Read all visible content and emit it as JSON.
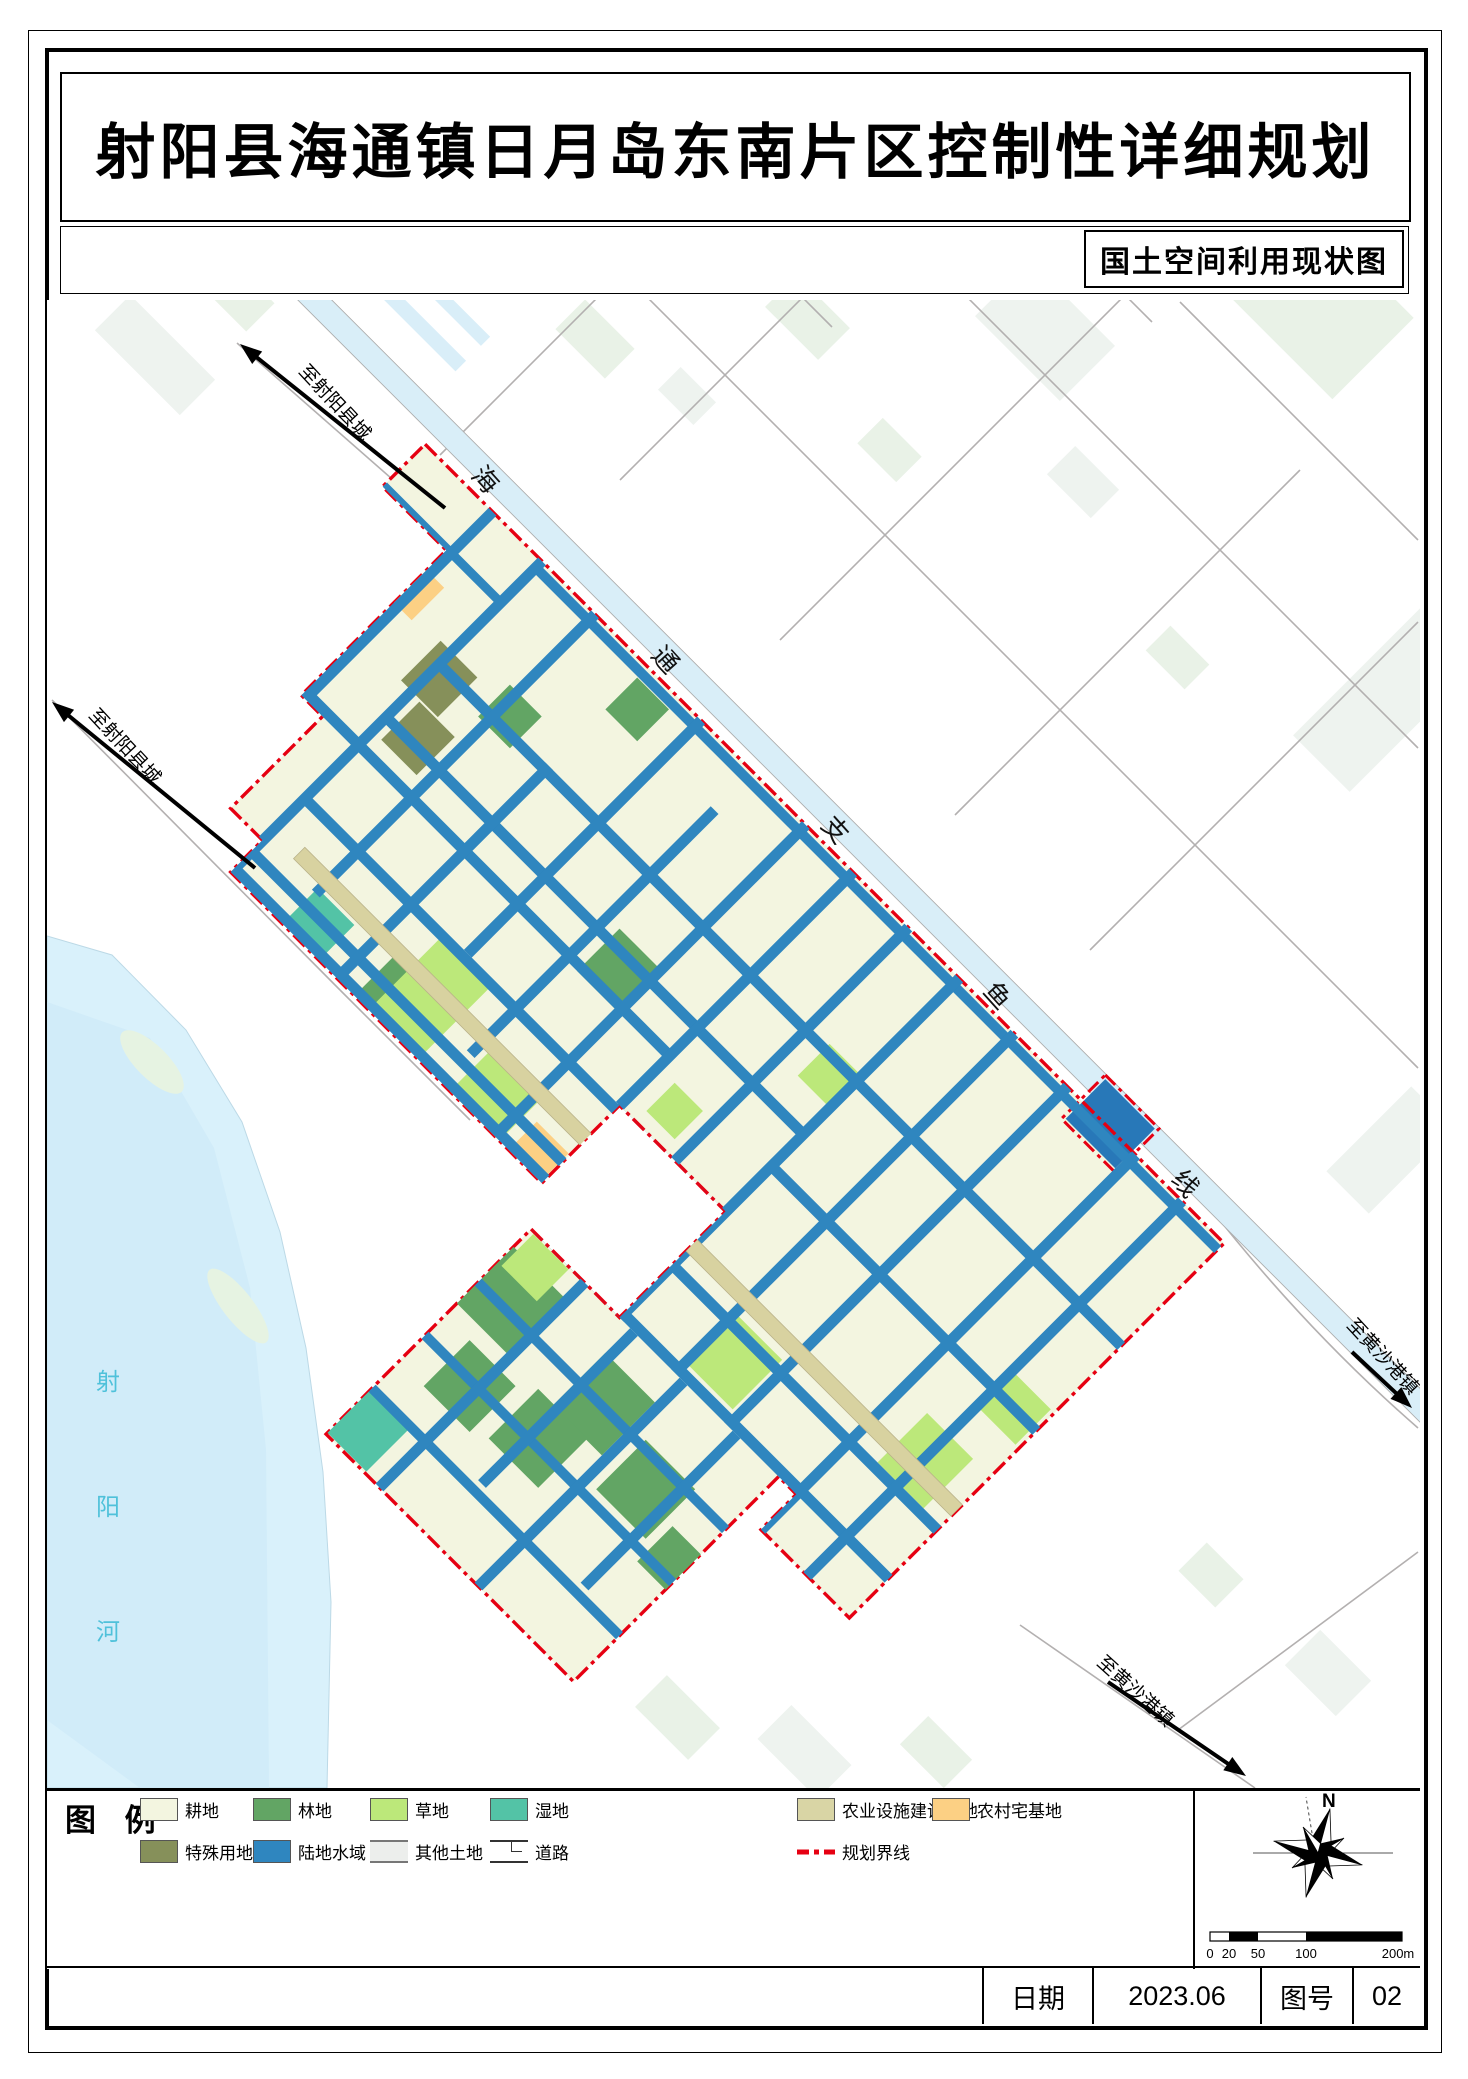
{
  "document": {
    "title": "射阳县海通镇日月岛东南片区控制性详细规划",
    "subtitle": "国土空间利用现状图"
  },
  "legend": {
    "title": "图 例",
    "items": [
      {
        "label": "耕地",
        "color": "#f3f5e0",
        "type": "fill",
        "row": 1,
        "col": 0
      },
      {
        "label": "林地",
        "color": "#62a564",
        "type": "fill",
        "row": 1,
        "col": 1
      },
      {
        "label": "草地",
        "color": "#bce87a",
        "type": "fill",
        "row": 1,
        "col": 2
      },
      {
        "label": "湿地",
        "color": "#53c3a6",
        "type": "fill",
        "row": 1,
        "col": 3
      },
      {
        "label": "农业设施建设用地",
        "color": "#d9d5a5",
        "type": "fill",
        "row": 1,
        "col": 4
      },
      {
        "label": "农村宅基地",
        "color": "#fcd084",
        "type": "fill",
        "row": 1,
        "col": 5
      },
      {
        "label": "特殊用地",
        "color": "#86905a",
        "type": "fill",
        "row": 2,
        "col": 0
      },
      {
        "label": "陆地水域",
        "color": "#2f86bf",
        "type": "fill",
        "row": 2,
        "col": 1
      },
      {
        "label": "其他土地",
        "color": "#eceeec",
        "type": "other",
        "row": 2,
        "col": 2
      },
      {
        "label": "道路",
        "color": "#ffffff",
        "type": "road",
        "row": 2,
        "col": 3
      },
      {
        "label": "规划界线",
        "color": "#e60012",
        "type": "boundary",
        "row": 2,
        "col": 4
      }
    ]
  },
  "map": {
    "canal_label_chars": [
      "海",
      "通",
      "支",
      "鱼",
      "线"
    ],
    "river_label_chars": [
      "射",
      "阳",
      "河"
    ],
    "destination_labels": [
      "至射阳县城",
      "至射阳县城",
      "至黄沙港镇",
      "至黄沙港镇"
    ]
  },
  "compass": {
    "north_label": "N"
  },
  "scale_bar": {
    "tick_labels": [
      "0",
      "20",
      "50",
      "100",
      "200m"
    ]
  },
  "footer": {
    "date_label": "日期",
    "date_value": "2023.06",
    "sheet_no_label": "图号",
    "sheet_no_value": "02"
  },
  "colors": {
    "cropland": "#f3f5e0",
    "forest": "#62a564",
    "grass": "#bce87a",
    "wetland": "#53c3a6",
    "agri_facility": "#d9d5a5",
    "homestead": "#fcd084",
    "special": "#86905a",
    "water": "#2f86bf",
    "canal": "#d9eef8",
    "river": "#d9f1fb",
    "boundary_red": "#e60012",
    "tan_road": "#d8d2a0",
    "gray_road": "#b3b0b0",
    "river_text": "#4fc1da",
    "pale_patch": "#e9f2e7"
  }
}
